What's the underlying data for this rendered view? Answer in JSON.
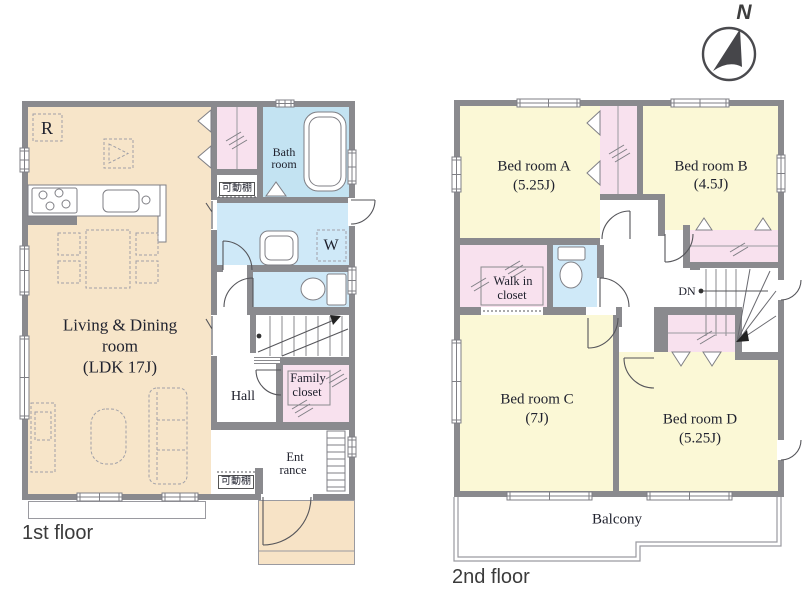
{
  "compass": {
    "north_label": "N"
  },
  "floor1": {
    "label": "1st floor",
    "living_line1": "Living & Dining",
    "living_line2": "room",
    "living_line3": "(LDK 17J)",
    "bath_line1": "Bath",
    "bath_line2": "room",
    "shelf_upper": "可動棚",
    "shelf_lower": "可動棚",
    "hall": "Hall",
    "family_line1": "Family",
    "family_line2": "closet",
    "entrance_line1": "Ent",
    "entrance_line2": "rance",
    "fridge": "R",
    "washer": "W"
  },
  "floor2": {
    "label": "2nd floor",
    "bedroom_a_name": "Bed room A",
    "bedroom_a_size": "(5.25J)",
    "bedroom_b_name": "Bed room B",
    "bedroom_b_size": "(4.5J)",
    "bedroom_c_name": "Bed room C",
    "bedroom_c_size": "(7J)",
    "bedroom_d_name": "Bed room D",
    "bedroom_d_size": "(5.25J)",
    "wic_line1": "Walk in",
    "wic_line2": "closet",
    "down": "DN",
    "balcony": "Balcony"
  },
  "colors": {
    "wall": "#8a8a8e",
    "living": "#f7e5c9",
    "bedroom": "#fbf8d6",
    "closet": "#f8e1ee",
    "water": "#cfe9f8",
    "bath": "#c3e3f2",
    "porch": "#f7e3c6",
    "line": "#8a8a8e",
    "text": "#20222e"
  }
}
